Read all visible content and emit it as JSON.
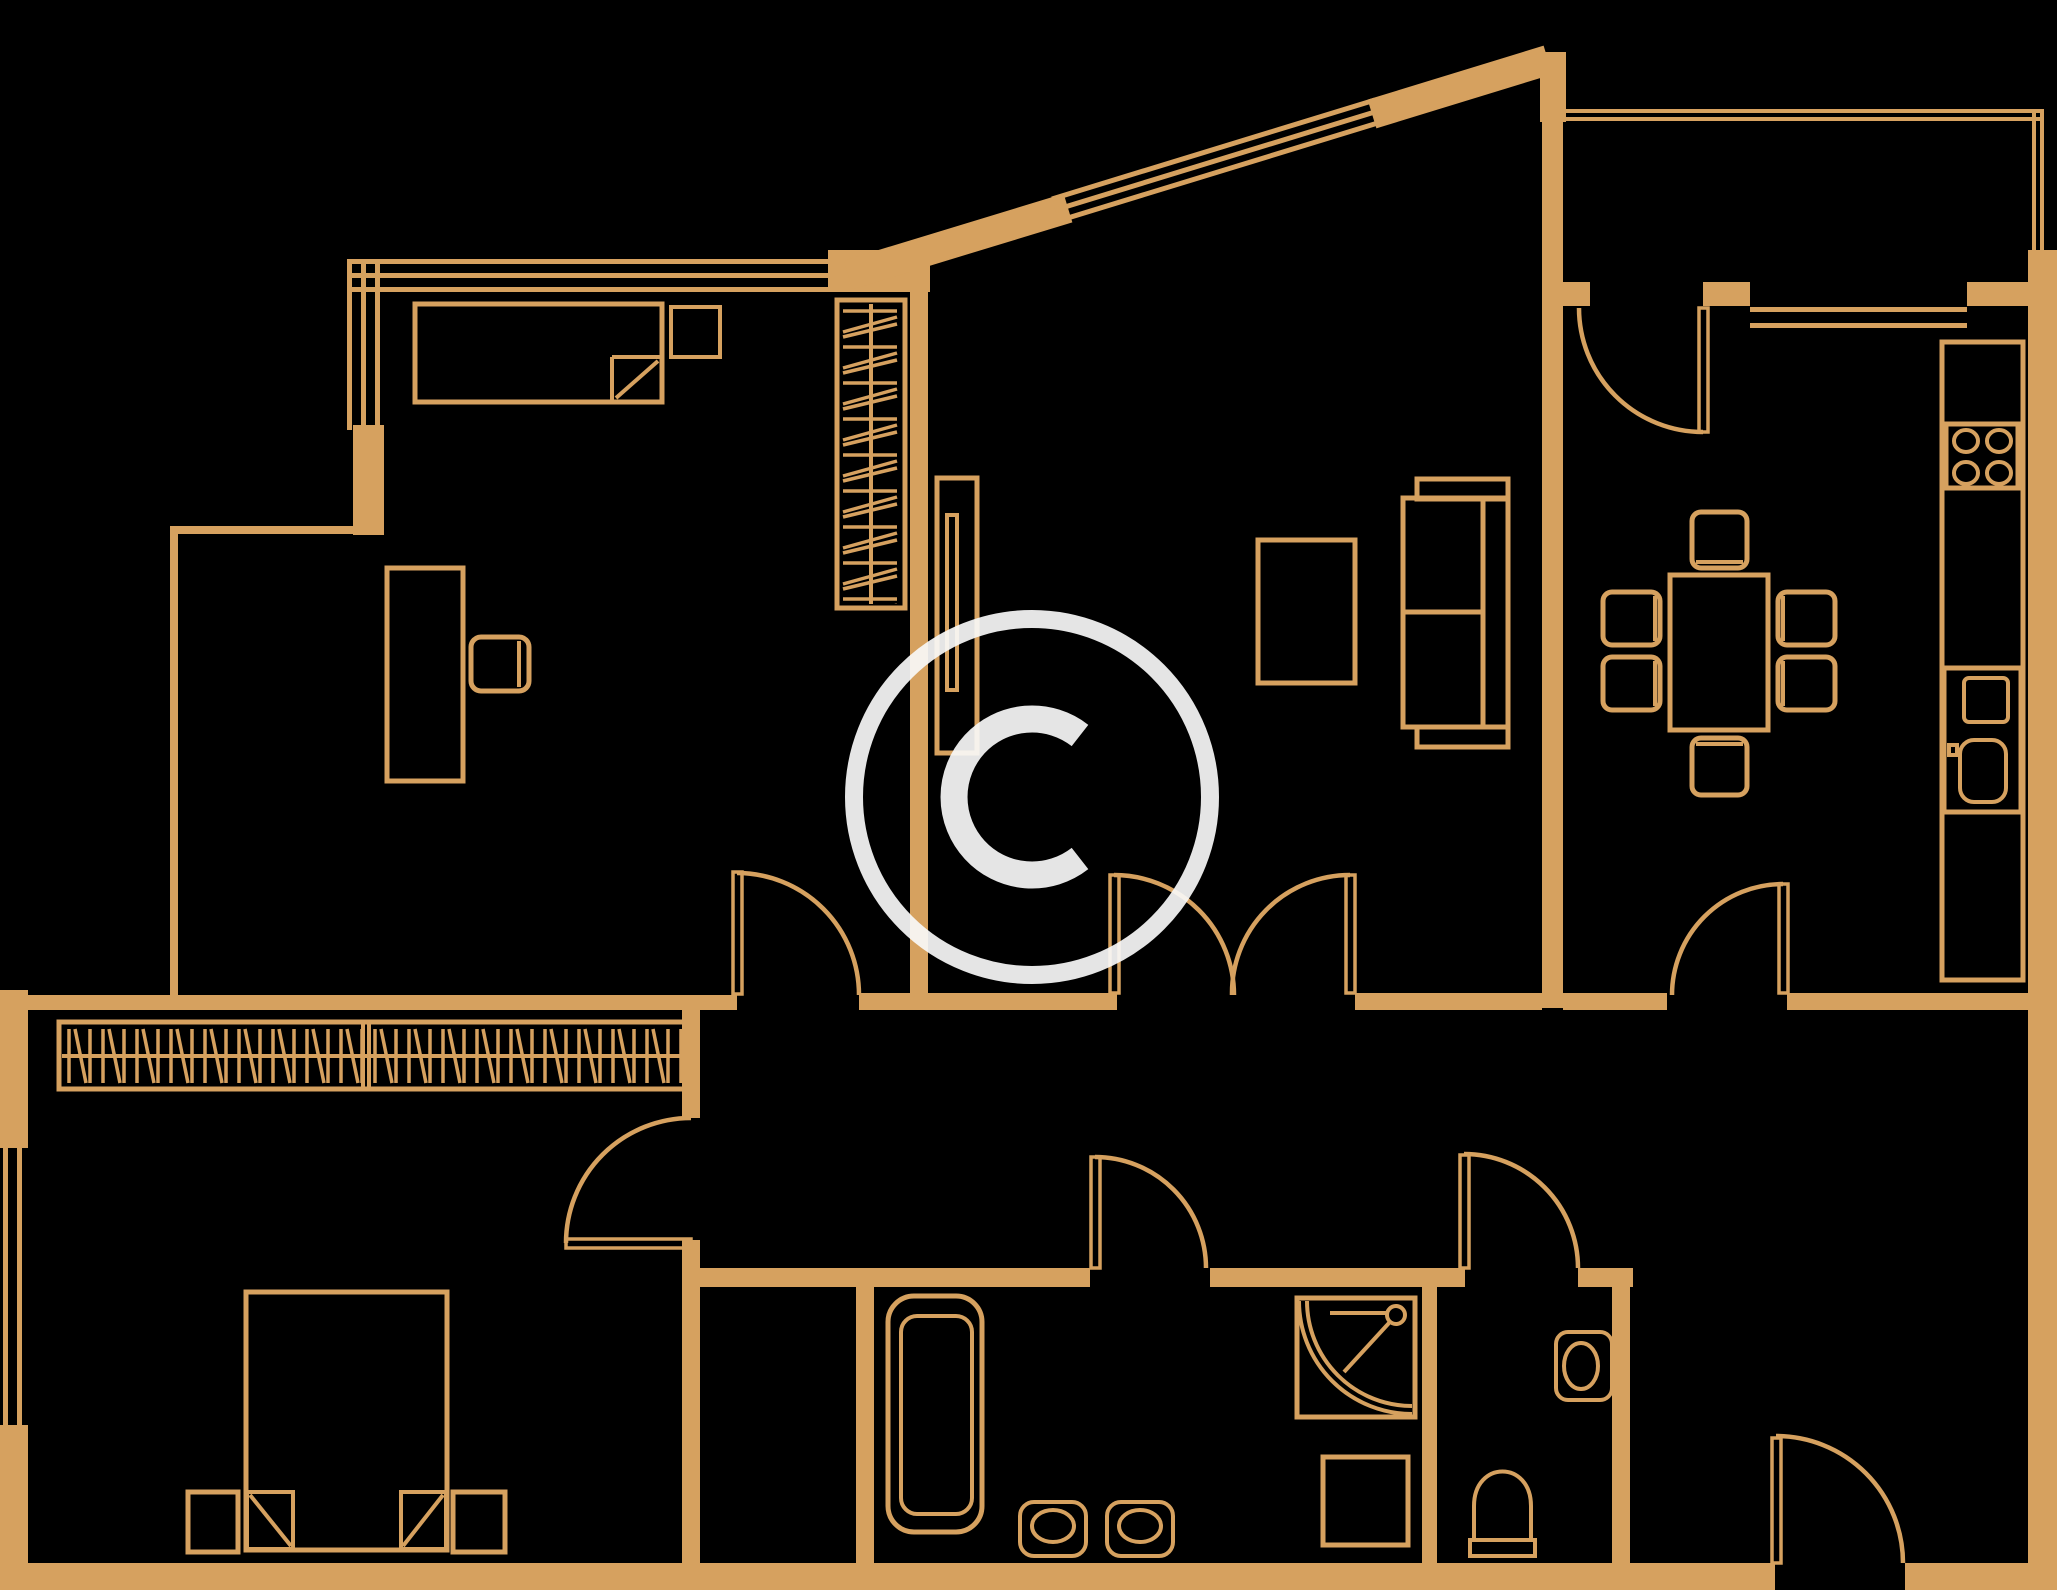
{
  "colors": {
    "background": "#000000",
    "plan_line": "#d6a15f",
    "watermark": "#f8f8f8"
  },
  "watermark": {
    "symbol": "©"
  },
  "plan": {
    "rooms": [
      {
        "name": "bedroom-1",
        "furniture": [
          "single-bed",
          "pillow",
          "desk",
          "desk-chair",
          "hatched-wardrobe",
          "sliding-panel"
        ]
      },
      {
        "name": "living-room",
        "furniture": [
          "sofa",
          "tv-sideboard"
        ]
      },
      {
        "name": "kitchen",
        "furniture": [
          "dining-table",
          "six-chairs",
          "counter",
          "stove-4-burners",
          "kitchen-sink-cabinet"
        ]
      },
      {
        "name": "loggia",
        "furniture": []
      },
      {
        "name": "bedroom-2",
        "furniture": [
          "double-bed",
          "two-pillows",
          "two-nightstands",
          "hatched-closet-row"
        ]
      },
      {
        "name": "bathroom",
        "furniture": [
          "bathtub",
          "washbasin-1",
          "washbasin-2",
          "corner-shower",
          "washing-machine"
        ]
      },
      {
        "name": "wc",
        "furniture": [
          "toilet",
          "wall-washbasin"
        ]
      },
      {
        "name": "hallway",
        "furniture": []
      },
      {
        "name": "entrance-hall",
        "furniture": []
      }
    ],
    "doors": [
      "bedroom-1-door",
      "bedroom-2-door",
      "double-door-living-room",
      "kitchen-hall-door",
      "kitchen-loggia-door",
      "bathroom-door",
      "wc-door",
      "entrance-door"
    ],
    "windows": [
      "bedroom-1-top-window",
      "bedroom-1-left-window",
      "diagonal-facade-window",
      "kitchen-window",
      "bedroom-2-window",
      "loggia-glazing"
    ]
  }
}
